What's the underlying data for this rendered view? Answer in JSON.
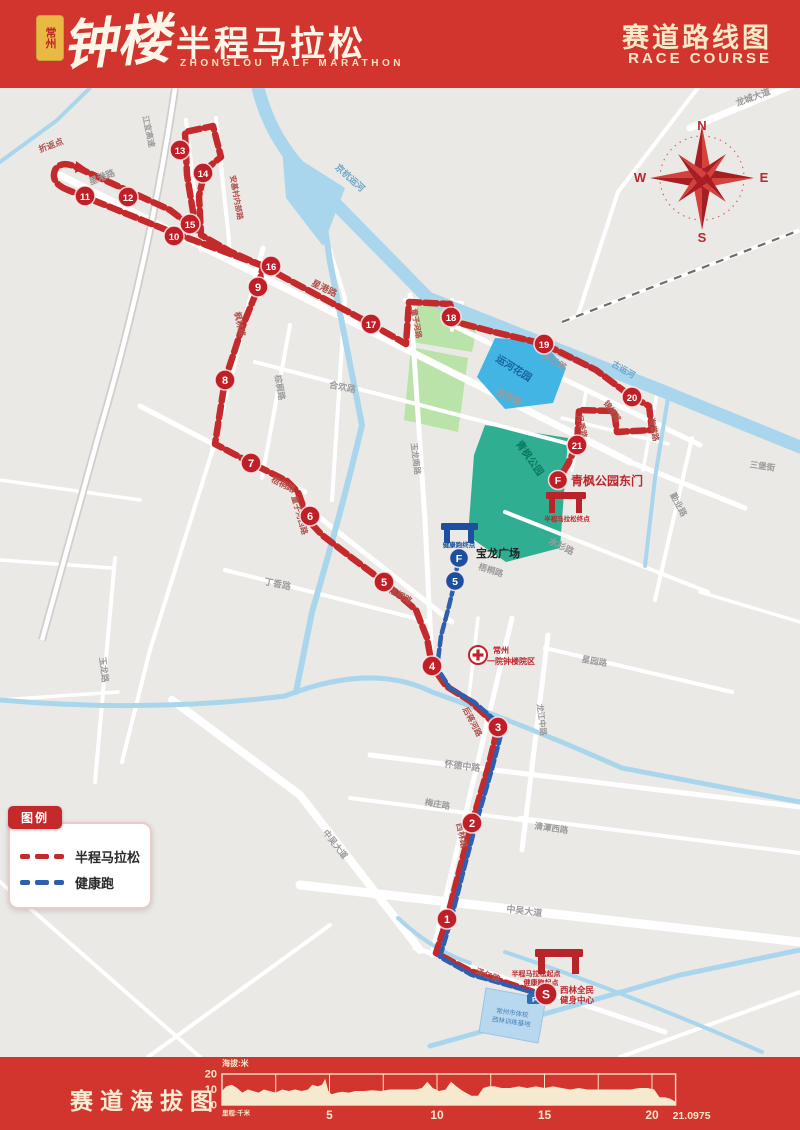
{
  "header": {
    "seal": "常州",
    "title_script": "钟楼",
    "title_main": "半程马拉松",
    "title_sub": "ZHONGLOU HALF MARATHON",
    "right_title": "赛道路线图",
    "right_sub": "RACE COURSE"
  },
  "compass": {
    "points": [
      "N",
      "E",
      "S",
      "W"
    ]
  },
  "legend": {
    "title": "图例",
    "items": [
      {
        "label": "半程马拉松",
        "color": "#c4292b"
      },
      {
        "label": "健康跑",
        "color": "#2e5fae"
      }
    ]
  },
  "map": {
    "km_markers": [
      {
        "n": "1",
        "x": 447,
        "y": 919
      },
      {
        "n": "2",
        "x": 472,
        "y": 823
      },
      {
        "n": "3",
        "x": 498,
        "y": 727
      },
      {
        "n": "4",
        "x": 432,
        "y": 666
      },
      {
        "n": "5",
        "x": 384,
        "y": 582
      },
      {
        "n": "6",
        "x": 310,
        "y": 516
      },
      {
        "n": "7",
        "x": 251,
        "y": 463
      },
      {
        "n": "8",
        "x": 225,
        "y": 380
      },
      {
        "n": "9",
        "x": 258,
        "y": 287
      },
      {
        "n": "10",
        "x": 174,
        "y": 236
      },
      {
        "n": "11",
        "x": 85,
        "y": 196
      },
      {
        "n": "12",
        "x": 128,
        "y": 197
      },
      {
        "n": "13",
        "x": 180,
        "y": 150
      },
      {
        "n": "14",
        "x": 203,
        "y": 173
      },
      {
        "n": "15",
        "x": 190,
        "y": 224
      },
      {
        "n": "16",
        "x": 271,
        "y": 266
      },
      {
        "n": "17",
        "x": 371,
        "y": 324
      },
      {
        "n": "18",
        "x": 451,
        "y": 317
      },
      {
        "n": "19",
        "x": 544,
        "y": 344
      },
      {
        "n": "20",
        "x": 632,
        "y": 397
      },
      {
        "n": "21",
        "x": 577,
        "y": 445
      }
    ],
    "start_marker": {
      "n": "S",
      "x": 546,
      "y": 994
    },
    "finish_marker": {
      "n": "F",
      "x": 558,
      "y": 480
    },
    "health_markers": [
      {
        "n": "F",
        "x": 459,
        "y": 558
      },
      {
        "n": "5",
        "x": 455,
        "y": 581
      }
    ],
    "road_labels": [
      {
        "text": "折返点",
        "x": 52,
        "y": 148,
        "r": -20,
        "c": "r",
        "s": 8.5
      },
      {
        "text": "星港路",
        "x": 103,
        "y": 180,
        "r": -21,
        "c": "g",
        "s": 9
      },
      {
        "text": "安基村内部路",
        "x": 234,
        "y": 198,
        "r": 80,
        "c": "r",
        "s": 7.5
      },
      {
        "text": "江宜高速",
        "x": 146,
        "y": 132,
        "r": 78,
        "c": "g",
        "s": 8
      },
      {
        "text": "京杭运河",
        "x": 348,
        "y": 180,
        "r": 42,
        "c": "w",
        "s": 9
      },
      {
        "text": "龙城大道",
        "x": 754,
        "y": 100,
        "r": -20,
        "c": "g",
        "s": 9
      },
      {
        "text": "星港路",
        "x": 323,
        "y": 291,
        "r": 26,
        "c": "r",
        "s": 9
      },
      {
        "text": "星港路",
        "x": 508,
        "y": 400,
        "r": 25,
        "c": "g",
        "s": 9
      },
      {
        "text": "枫林路",
        "x": 237,
        "y": 325,
        "r": 78,
        "c": "r",
        "s": 8.5
      },
      {
        "text": "合欢路",
        "x": 342,
        "y": 390,
        "r": 11,
        "c": "g",
        "s": 9
      },
      {
        "text": "棕榈路",
        "x": 277,
        "y": 388,
        "r": 80,
        "c": "g",
        "s": 8.5
      },
      {
        "text": "玉兰路",
        "x": 553,
        "y": 364,
        "r": 32,
        "c": "g",
        "s": 9
      },
      {
        "text": "古运河",
        "x": 622,
        "y": 372,
        "r": 30,
        "c": "w",
        "s": 8.5
      },
      {
        "text": "月季路",
        "x": 579,
        "y": 427,
        "r": 78,
        "c": "r",
        "s": 8
      },
      {
        "text": "锦绣路",
        "x": 610,
        "y": 413,
        "r": 55,
        "c": "r",
        "s": 8
      },
      {
        "text": "海棠路",
        "x": 651,
        "y": 430,
        "r": 78,
        "c": "r",
        "s": 8
      },
      {
        "text": "勤业路",
        "x": 676,
        "y": 506,
        "r": 62,
        "c": "g",
        "s": 8.5
      },
      {
        "text": "水杉路",
        "x": 560,
        "y": 549,
        "r": 26,
        "c": "g",
        "s": 9
      },
      {
        "text": "梧桐路",
        "x": 282,
        "y": 487,
        "r": 27,
        "c": "r",
        "s": 8.5
      },
      {
        "text": "童子河西路",
        "x": 297,
        "y": 516,
        "r": 74,
        "c": "r",
        "s": 8
      },
      {
        "text": "梧桐路",
        "x": 399,
        "y": 598,
        "r": 30,
        "c": "r",
        "s": 8.5
      },
      {
        "text": "丁香路",
        "x": 277,
        "y": 587,
        "r": 12,
        "c": "g",
        "s": 9
      },
      {
        "text": "玉龙南路",
        "x": 413,
        "y": 459,
        "r": 83,
        "c": "g",
        "s": 8
      },
      {
        "text": "梧桐路",
        "x": 490,
        "y": 573,
        "r": 18,
        "c": "g",
        "s": 8.5
      },
      {
        "text": "玉龙路",
        "x": 101,
        "y": 670,
        "r": 83,
        "c": "g",
        "s": 8.5
      },
      {
        "text": "怀德中路",
        "x": 462,
        "y": 769,
        "r": 7,
        "c": "g",
        "s": 9
      },
      {
        "text": "梅庄路",
        "x": 437,
        "y": 807,
        "r": 10,
        "c": "g",
        "s": 8.5
      },
      {
        "text": "西林路",
        "x": 459,
        "y": 836,
        "r": 78,
        "c": "r",
        "s": 8.5
      },
      {
        "text": "后蒋河路",
        "x": 470,
        "y": 723,
        "r": 62,
        "c": "r",
        "s": 8
      },
      {
        "text": "龙江中路",
        "x": 539,
        "y": 720,
        "r": 83,
        "c": "g",
        "s": 8
      },
      {
        "text": "星园路",
        "x": 594,
        "y": 664,
        "r": 10,
        "c": "g",
        "s": 8.5
      },
      {
        "text": "清潭西路",
        "x": 551,
        "y": 831,
        "r": 8,
        "c": "g",
        "s": 8.5
      },
      {
        "text": "中吴大道",
        "x": 524,
        "y": 914,
        "r": 7,
        "c": "g",
        "s": 9
      },
      {
        "text": "中吴大道",
        "x": 333,
        "y": 846,
        "r": 52,
        "c": "g",
        "s": 8.5
      },
      {
        "text": "泽仁路",
        "x": 487,
        "y": 978,
        "r": 20,
        "c": "r",
        "s": 8.5
      },
      {
        "text": "三堡街",
        "x": 762,
        "y": 469,
        "r": 8,
        "c": "g",
        "s": 8.5
      },
      {
        "text": "童子河路",
        "x": 414,
        "y": 324,
        "r": 80,
        "c": "r",
        "s": 7.5
      }
    ],
    "landmarks": {
      "baolong": "宝龙广场",
      "qingfeng_gate": "青枫公园东门",
      "canal_garden": "运河花园",
      "qingfeng_park": "青枫公园",
      "hospital_line1": "常州",
      "hospital_line2": "一院钟楼院区",
      "start_note1": "半程马拉松起点",
      "start_note2": "健康跑起点",
      "finish_note": "半程马拉松终点",
      "health_finish_note": "健康跑终点",
      "s_label_line1": "西林全民",
      "s_label_line2": "健身中心",
      "school_line1": "常州市体校",
      "school_line2": "西林训练基地",
      "parking": "P"
    }
  },
  "footer": {
    "title": "赛道海拔图"
  },
  "chart_data": {
    "type": "area",
    "title": "赛道海拔图",
    "ylabel": "海拔:米",
    "xlabel": "里程:千米",
    "ylim": [
      0,
      20
    ],
    "yticks": [
      0,
      10,
      20
    ],
    "xticks": [
      5,
      10,
      15,
      20
    ],
    "end_label": "21.0975",
    "total_km": 21.0975,
    "grid_step_km": 2.5,
    "profile_km": [
      0,
      0.2,
      0.45,
      0.7,
      0.95,
      1.2,
      1.45,
      1.7,
      1.95,
      2.2,
      2.5,
      2.8,
      3.1,
      3.4,
      3.7,
      4.0,
      4.2,
      4.45,
      4.65,
      4.8,
      4.95,
      5.1,
      5.35,
      5.6,
      5.9,
      6.2,
      6.6,
      7.0,
      7.4,
      7.8,
      8.2,
      8.6,
      9.0,
      9.3,
      9.55,
      9.8,
      10.1,
      10.4,
      10.65,
      10.9,
      11.2,
      11.6,
      11.9,
      12.15,
      12.4,
      12.7,
      13.0,
      13.4,
      13.8,
      14.2,
      14.6,
      15.0,
      15.4,
      15.8,
      16.2,
      16.6,
      17.0,
      17.4,
      17.8,
      18.2,
      18.6,
      19.0,
      19.4,
      19.8,
      20.1,
      20.35,
      20.6,
      20.85,
      21.0975
    ],
    "profile_m": [
      9,
      12,
      13,
      11,
      8,
      10,
      9,
      8,
      10,
      9,
      8,
      10,
      9,
      10,
      9,
      10,
      13,
      12,
      13,
      17,
      9,
      7,
      8,
      8.5,
      8,
      9,
      9,
      9.5,
      9,
      10,
      10,
      10,
      10,
      11,
      15,
      11,
      9,
      10,
      15,
      12,
      9,
      6,
      6,
      11,
      12,
      12,
      11,
      11,
      12,
      11,
      12,
      11,
      12,
      11,
      10,
      11,
      10,
      10,
      10,
      10,
      10,
      10,
      11,
      11,
      10,
      5,
      5,
      4,
      2
    ]
  }
}
